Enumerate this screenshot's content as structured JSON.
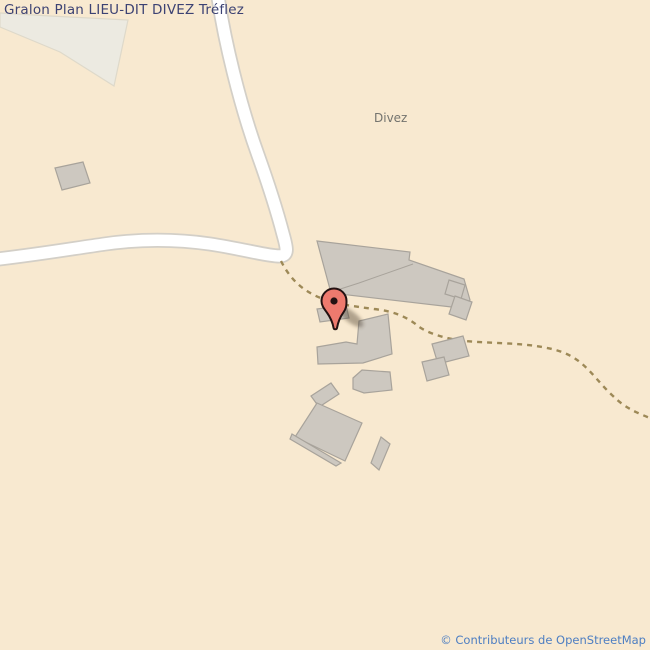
{
  "page": {
    "title": "Gralon Plan LIEU-DIT DIVEZ Tréflez",
    "attribution": "© Contributeurs de OpenStreetMap"
  },
  "map": {
    "place_label": "Divez",
    "colors": {
      "background": "#f8e9d0",
      "landuse_fill": "#eceae1",
      "landuse_stroke": "#ded9ca",
      "road_fill": "#ffffff",
      "road_casing": "#d3cfc7",
      "track_stroke": "#9d8957",
      "building_fill": "#cdc8c0",
      "building_stroke": "#a8a39b",
      "marker_fill": "#ee7a6e",
      "marker_stroke": "#241212",
      "shadow_fill": "rgba(70,55,40,0.40)",
      "title_color": "#3c4273",
      "label_color": "#73736e",
      "attribution_color": "#4d7ec2"
    },
    "marker": {
      "x": 334,
      "y": 301,
      "shadow_cx": 351,
      "shadow_cy": 317
    },
    "geometry": {
      "landuse": [
        {
          "name": "landuse-area-topleft",
          "points": "0,13 50,16 128,20 114,86 60,52 0,27"
        }
      ],
      "roads": [
        {
          "name": "main-road",
          "d": "M 217,-10 C 224,40 240,105 258,155 C 268,183 278,215 283,234 C 287,248 289,256 279,256 C 267,256 243,249 210,244 C 175,239 140,239 105,244 C 70,249 35,255 -10,260"
        }
      ],
      "tracks": [
        {
          "name": "farm-track",
          "d": "M 281,261 C 288,275 298,287 314,295 C 332,304 352,306 374,309 C 392,311 406,316 418,326 C 427,333 446,339 465,341 C 487,343 516,343 536,346 C 556,349 569,353 581,363 C 592,372 601,385 613,396 C 625,408 637,413 655,420"
        }
      ],
      "buildings": [
        {
          "name": "building-large-north",
          "points": "317,241 410,252 409,260 464,279 470,300 460,308 331,293"
        },
        {
          "name": "building-annex-east-1",
          "points": "449,280 465,285 461,299 445,294"
        },
        {
          "name": "building-annex-east-2",
          "points": "455,296 472,302 466,320 449,314"
        },
        {
          "name": "building-small-marker",
          "points": "317,309 346,305 349,318 320,322"
        },
        {
          "name": "building-l-shape",
          "points": "317,347 346,342 357,344 359,321 388,314 392,354 363,363 318,364"
        },
        {
          "name": "building-mid-south",
          "points": "353,378 362,370 390,372 392,390 364,393 353,389"
        },
        {
          "name": "building-small-tilted",
          "points": "311,396 331,383 339,394 319,407"
        },
        {
          "name": "building-large-south",
          "points": "317,403 362,423 345,461 295,437"
        },
        {
          "name": "building-south-sliver",
          "points": "292,434 341,463 336,466 290,439"
        },
        {
          "name": "building-thin-sliver",
          "points": "381,437 390,444 379,470 371,463"
        },
        {
          "name": "building-east-1",
          "points": "432,344 463,336 469,356 438,364"
        },
        {
          "name": "building-east-2",
          "points": "422,362 444,357 449,375 427,381"
        },
        {
          "name": "building-far-west",
          "points": "55,168 83,162 90,183 62,190"
        }
      ],
      "rooflines": [
        {
          "name": "building-roofline",
          "points": "331,292 359,283 413,264"
        }
      ]
    }
  }
}
